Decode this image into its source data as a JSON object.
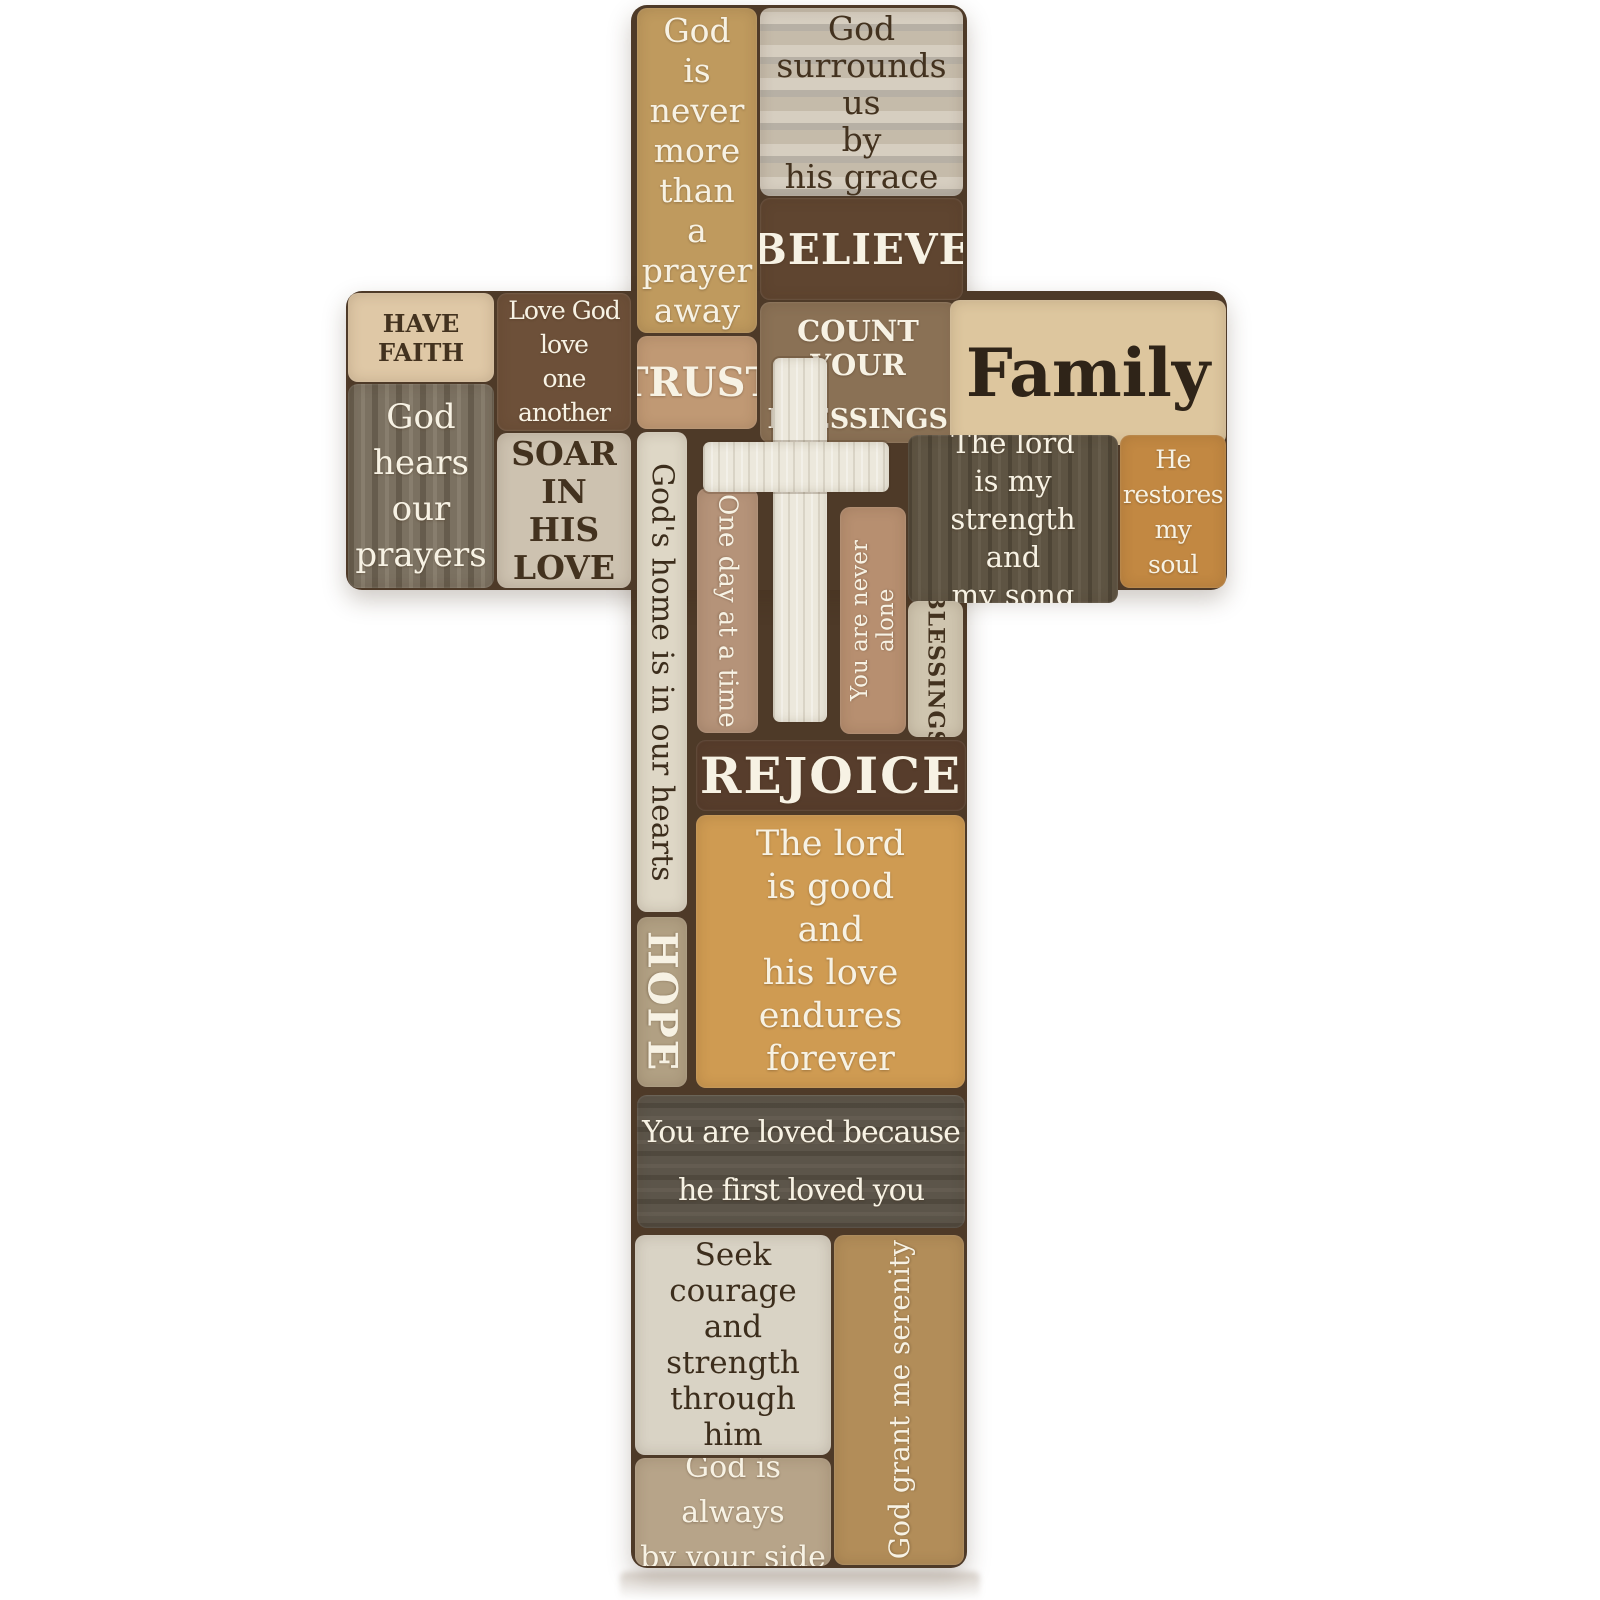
{
  "product": {
    "description_visible": "Rustic wood-block collage wall cross with inspirational sayings"
  },
  "palette": {
    "base_seam_brown": "#4e3a28",
    "white_cross": "#ece8dc",
    "light_text": "#f7f2e4",
    "dark_text": "#43321f",
    "tan": "#bf9a5e",
    "light_gray_wood": "#cdc3b2",
    "dark_brown": "#5f4530",
    "golden_wood": "#cf9b52",
    "olive_brown": "#5e5443",
    "orange_wood": "#c28842",
    "pink_brown": "#b78f70",
    "cream": "#ded7c6"
  },
  "blocks": {
    "god_is_never": {
      "text": "God\nis\nnever\nmore\nthan\na\nprayer\naway"
    },
    "god_surrounds": {
      "text": "God\nsurrounds\nus\nby\nhis grace"
    },
    "believe": {
      "text": "BELIEVE"
    },
    "trust": {
      "text": "TRUST"
    },
    "count_your": {
      "line1": "COUNT YOUR",
      "line2": "BLESSINGS"
    },
    "family": {
      "text": "Family"
    },
    "have_faith": {
      "text": "HAVE FAITH"
    },
    "god_hears": {
      "text": "God\nhears\nour\nprayers"
    },
    "love_god": {
      "text": "Love God\nlove\none another"
    },
    "soar": {
      "text": "SOAR\nIN\nHIS\nLOVE"
    },
    "lord_strength": {
      "text": "The lord\nis my strength\nand\nmy song"
    },
    "he_restores": {
      "text": "He\nrestores\nmy\nsoul"
    },
    "gods_home": {
      "text": "God's home is in our hearts"
    },
    "one_day": {
      "text": "One day at a time"
    },
    "never_alone": {
      "text": "You are never alone"
    },
    "blessings_vertical": {
      "text": "BLESSINGS"
    },
    "rejoice": {
      "text": "REJOICE"
    },
    "lord_good": {
      "text": "The lord\nis good\nand\nhis love\nendures\nforever"
    },
    "hope": {
      "text": "HOPE"
    },
    "you_are_loved": {
      "text": "You are loved because\nhe first loved you"
    },
    "seek_courage": {
      "text": "Seek\ncourage\nand\nstrength\nthrough\nhim"
    },
    "serenity": {
      "text": "God grant me serenity"
    },
    "god_always": {
      "text": "God is always\nby your side"
    }
  }
}
